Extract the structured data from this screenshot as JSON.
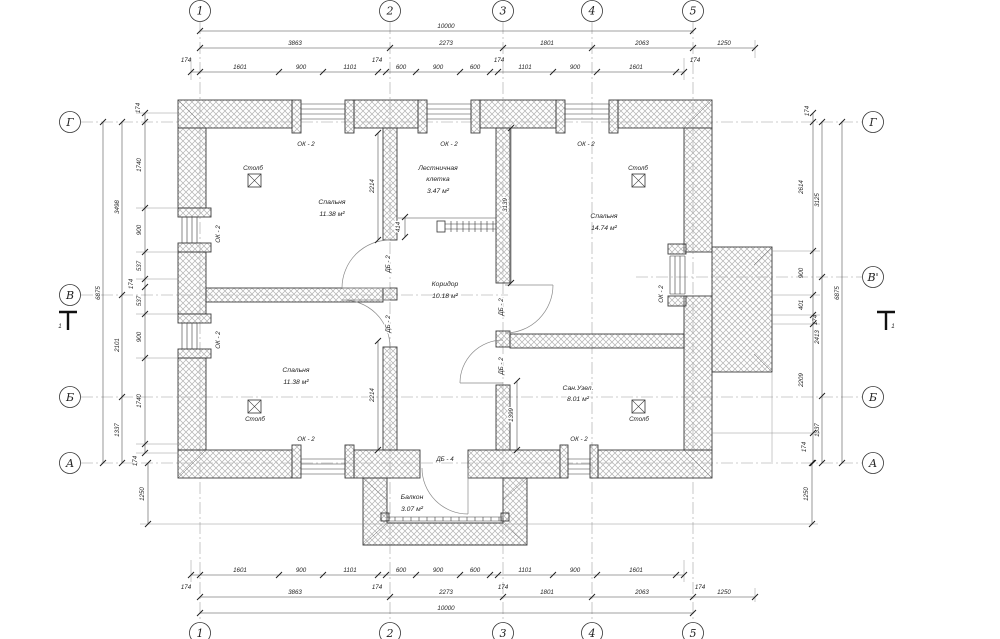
{
  "axes": {
    "top": [
      "1",
      "2",
      "3",
      "4",
      "5"
    ],
    "bottom": [
      "1",
      "2",
      "3",
      "4",
      "5"
    ],
    "left": [
      "Г",
      "В",
      "Б",
      "А"
    ],
    "right": [
      "Г",
      "В'",
      "Б",
      "А"
    ]
  },
  "section_marks": {
    "left": "1",
    "right": "1"
  },
  "dims": {
    "top_total": "10000",
    "top_major": [
      "3863",
      "2273",
      "1801",
      "2063",
      "1250"
    ],
    "top_minor": [
      "174",
      "1601",
      "900",
      "1101",
      "174",
      "600",
      "900",
      "600",
      "174",
      "1101",
      "900",
      "1601",
      "174"
    ],
    "bottom_total": "10000",
    "bottom_major": [
      "3863",
      "2273",
      "1801",
      "2063",
      "1250"
    ],
    "bottom_minor": [
      "174",
      "1601",
      "900",
      "1101",
      "174",
      "600",
      "900",
      "600",
      "174",
      "1101",
      "900",
      "1601",
      "174"
    ],
    "left_total": "6875",
    "left_major": [
      "3498",
      "2101",
      "1337"
    ],
    "left_minor": [
      "174",
      "1740",
      "900",
      "537",
      "174",
      "537",
      "900",
      "1740",
      "174"
    ],
    "left_offset": "1250",
    "right_total": "6875",
    "right_major": [
      "3125",
      "2413",
      "1337"
    ],
    "right_minor": [
      "174",
      "2614",
      "900",
      "401",
      "174",
      "2209",
      "174"
    ],
    "right_offset": "1250",
    "interior": {
      "d2214_top": "2214",
      "d3139": "3139",
      "d414": "414",
      "d2214_bottom": "2214",
      "d1399": "1399"
    }
  },
  "rooms": {
    "bedroom_tl": {
      "name": "Спальня",
      "area": "11.38 м²"
    },
    "stairwell": {
      "name_line1": "Лестничная",
      "name_line2": "клетка",
      "area": "3.47 м²"
    },
    "bedroom_tr": {
      "name": "Спальня",
      "area": "14.74 м²"
    },
    "corridor": {
      "name": "Коридор",
      "area": "10.18 м²"
    },
    "bedroom_bl": {
      "name": "Спальня",
      "area": "11.38 м²"
    },
    "bathroom": {
      "name": "Сан.Узел.",
      "area": "8.01 м²"
    },
    "balcony": {
      "name": "Балкон",
      "area": "3.07 м²"
    }
  },
  "labels": {
    "column": "Столб",
    "window": "ОК - 2",
    "door": "ДБ - 2",
    "balcony_door": "ДБ - 4"
  }
}
